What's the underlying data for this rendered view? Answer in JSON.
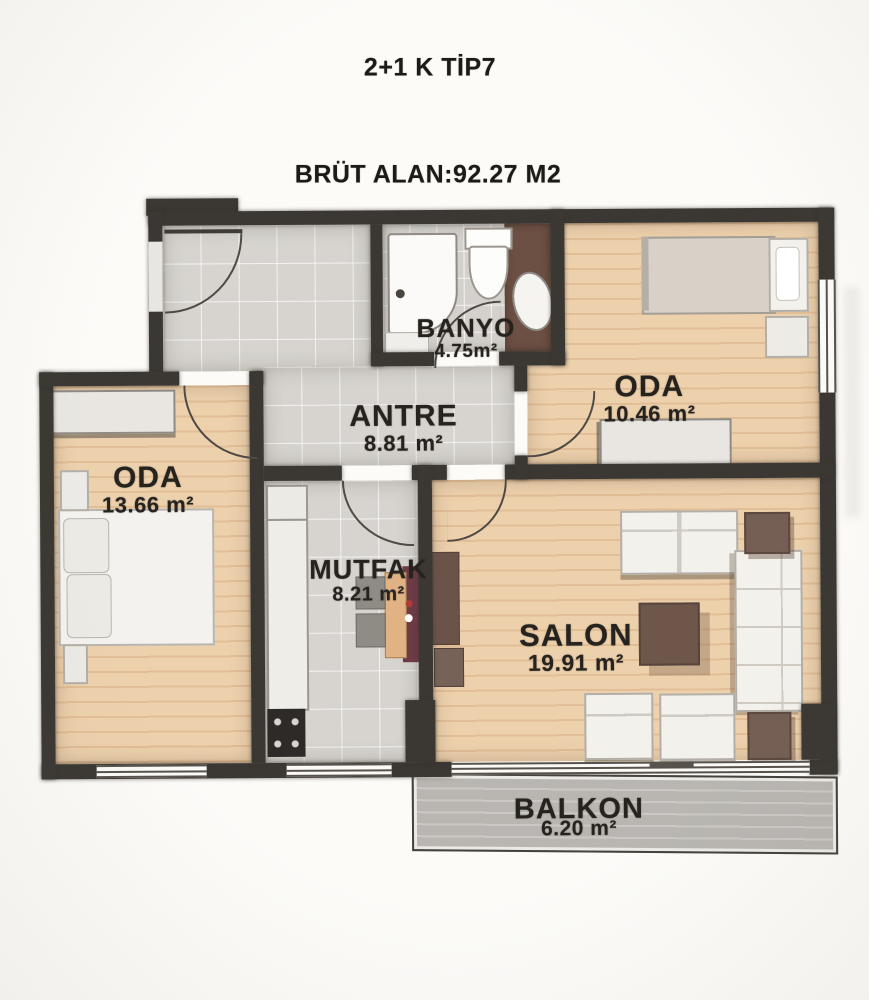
{
  "page": {
    "title": "2+1 K TİP7",
    "subtitle": "BRÜT ALAN:92.27 M2"
  },
  "rooms": {
    "banyo": {
      "name": "BANYO",
      "area": "4.75m²"
    },
    "oda_sag": {
      "name": "ODA",
      "area": "10.46 m²"
    },
    "antre": {
      "name": "ANTRE",
      "area": "8.81 m²"
    },
    "oda_sol": {
      "name": "ODA",
      "area": "13.66 m²"
    },
    "mutfak": {
      "name": "MUTFAK",
      "area": "8.21 m²"
    },
    "salon": {
      "name": "SALON",
      "area": "19.91 m²"
    },
    "balkon": {
      "name": "BALKON",
      "area": "6.20 m²"
    }
  },
  "colors": {
    "wall": "#3b3732",
    "wood_floor": "#edd1ad",
    "tile_floor": "#d7d4cf",
    "bath_vanity": "#6d5044",
    "balcony_floor": "#b9b6b1",
    "furniture_brown": "#755e53",
    "kitchen_runner_red": "#6d3b45",
    "text": "#26231f"
  }
}
